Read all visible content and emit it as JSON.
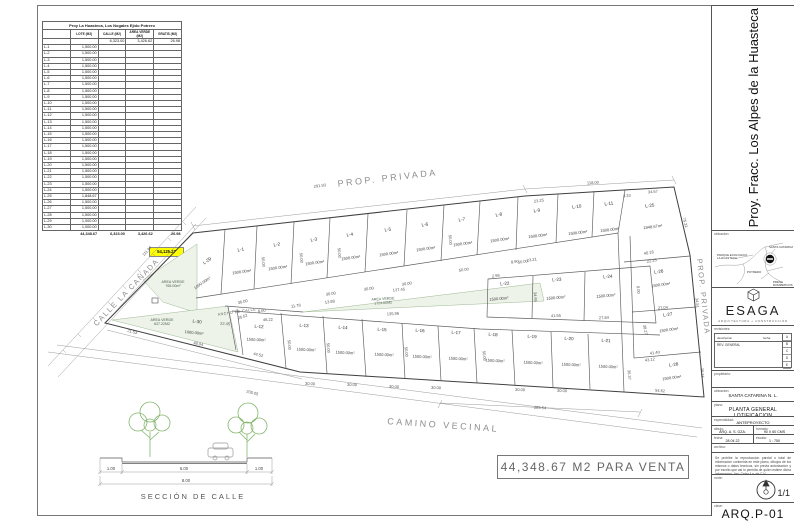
{
  "summary_table": {
    "title": "Proy La Huasteca, Los Nogales Ejido Potrero",
    "columns": [
      "",
      "LOTE (M2)",
      "CALLE (M2)",
      "AREA VERDE (M2)",
      "GRATIS (M2)"
    ],
    "subtotal_row": {
      "calle": "6,323.00",
      "area_verde": "3,426.62",
      "gratis": "26.98"
    },
    "rows": [
      {
        "id": "L-1",
        "lote": "1,500.00"
      },
      {
        "id": "L-2",
        "lote": "1,500.00"
      },
      {
        "id": "L-3",
        "lote": "1,500.00"
      },
      {
        "id": "L-4",
        "lote": "1,500.00"
      },
      {
        "id": "L-5",
        "lote": "1,500.00"
      },
      {
        "id": "L-6",
        "lote": "1,500.00"
      },
      {
        "id": "L-7",
        "lote": "1,500.00"
      },
      {
        "id": "L-8",
        "lote": "1,500.00"
      },
      {
        "id": "L-9",
        "lote": "1,500.00"
      },
      {
        "id": "L-10",
        "lote": "1,500.00"
      },
      {
        "id": "L-11",
        "lote": "1,500.00"
      },
      {
        "id": "L-12",
        "lote": "1,500.00"
      },
      {
        "id": "L-13",
        "lote": "1,500.00"
      },
      {
        "id": "L-14",
        "lote": "1,500.00"
      },
      {
        "id": "L-15",
        "lote": "1,500.00"
      },
      {
        "id": "L-16",
        "lote": "1,500.00"
      },
      {
        "id": "L-17",
        "lote": "1,500.00"
      },
      {
        "id": "L-18",
        "lote": "1,500.00"
      },
      {
        "id": "L-19",
        "lote": "1,500.00"
      },
      {
        "id": "L-20",
        "lote": "1,500.00"
      },
      {
        "id": "L-21",
        "lote": "1,500.00"
      },
      {
        "id": "L-22",
        "lote": "1,500.00"
      },
      {
        "id": "L-23",
        "lote": "1,500.00"
      },
      {
        "id": "L-24",
        "lote": "1,500.00"
      },
      {
        "id": "L-25",
        "lote": "1,848.67"
      },
      {
        "id": "L-26",
        "lote": "1,500.00"
      },
      {
        "id": "L-27",
        "lote": "1,500.00"
      },
      {
        "id": "L-28",
        "lote": "1,500.00"
      },
      {
        "id": "L-29",
        "lote": "1,000.00"
      },
      {
        "id": "L-30",
        "lote": "1,000.00"
      }
    ],
    "totals": {
      "lote": "44,348.67",
      "calle": "6,323.00",
      "area_verde": "3,426.62",
      "gratis": "26.98"
    },
    "grand_total": "54,125.27",
    "highlight_color": "#ffff00"
  },
  "plan": {
    "street_labels": {
      "prop_top": "PROP. PRIVADA",
      "prop_right": "PROP. PRIVADA",
      "camino": "CAMINO VECINAL",
      "calle": "CALLE LA CAÑADA",
      "ancho": "ANCHO DE CALLE"
    },
    "sale_note": "44,348.67 M2 PARA VENTA",
    "lots": [
      {
        "id": "L-29",
        "area": "1000.00m²",
        "x": 208,
        "y": 262,
        "r": -35,
        "ax": 203,
        "ay": 284
      },
      {
        "id": "L-1",
        "area": "1500.00m²",
        "x": 241,
        "y": 251,
        "r": -8,
        "ax": 242,
        "ay": 273
      },
      {
        "id": "L-2",
        "area": "1500.00m²",
        "x": 277,
        "y": 246,
        "r": -8,
        "ax": 278,
        "ay": 269
      },
      {
        "id": "L-3",
        "area": "1500.00m²",
        "x": 314,
        "y": 241,
        "r": -8,
        "ax": 315,
        "ay": 264
      },
      {
        "id": "L-4",
        "area": "1500.00m²",
        "x": 350,
        "y": 236,
        "r": -8,
        "ax": 351,
        "ay": 259
      },
      {
        "id": "L-5",
        "area": "1500.00m²",
        "x": 388,
        "y": 231,
        "r": -8,
        "ax": 389,
        "ay": 255
      },
      {
        "id": "L-6",
        "area": "1500.00m²",
        "x": 425,
        "y": 226,
        "r": -8,
        "ax": 426,
        "ay": 250
      },
      {
        "id": "L-7",
        "area": "1500.00m²",
        "x": 462,
        "y": 221,
        "r": -8,
        "ax": 463,
        "ay": 245
      },
      {
        "id": "L-8",
        "area": "1500.00m²",
        "x": 499,
        "y": 216,
        "r": -8,
        "ax": 500,
        "ay": 241
      },
      {
        "id": "L-9",
        "area": "1500.00m²",
        "x": 537,
        "y": 212,
        "r": -7,
        "ax": 538,
        "ay": 237
      },
      {
        "id": "L-10",
        "area": "1500.00m²",
        "x": 577,
        "y": 208,
        "r": -7,
        "ax": 578,
        "ay": 234
      },
      {
        "id": "L-11",
        "area": "1500.00m²",
        "x": 609,
        "y": 205,
        "r": -7,
        "ax": 610,
        "ay": 231
      },
      {
        "id": "L-25",
        "area": "1848.67m²",
        "x": 650,
        "y": 207,
        "r": -7,
        "ax": 653,
        "ay": 228
      },
      {
        "id": "L-26",
        "area": "1500.00m²",
        "x": 659,
        "y": 273,
        "r": -8,
        "ax": 661,
        "ay": 286
      },
      {
        "id": "L-27",
        "area": "1500.00m²",
        "x": 668,
        "y": 316,
        "r": -8,
        "ax": 669,
        "ay": 331
      },
      {
        "id": "L-28",
        "area": "1500.00m²",
        "x": 674,
        "y": 366,
        "r": -8,
        "ax": 672,
        "ay": 379
      },
      {
        "id": "L-22",
        "area": "1500.00m²",
        "x": 505,
        "y": 285,
        "r": -5,
        "ax": 499,
        "ay": 300
      },
      {
        "id": "L-23",
        "area": "1500.00m²",
        "x": 557,
        "y": 281,
        "r": -5,
        "ax": 556,
        "ay": 299
      },
      {
        "id": "L-24",
        "area": "1500.00m²",
        "x": 608,
        "y": 278,
        "r": -5,
        "ax": 606,
        "ay": 297
      },
      {
        "id": "L-30",
        "area": "1000.00m²",
        "x": 197,
        "y": 323,
        "r": 6,
        "ax": 194,
        "ay": 334
      },
      {
        "id": "L-12",
        "area": "1500.00m²",
        "x": 259,
        "y": 328,
        "r": 3,
        "ax": 256,
        "ay": 341
      },
      {
        "id": "L-13",
        "area": "1500.00m²",
        "x": 304,
        "y": 327,
        "r": 3,
        "ax": 306,
        "ay": 351
      },
      {
        "id": "L-14",
        "area": "1500.00m²",
        "x": 343,
        "y": 329,
        "r": 3,
        "ax": 345,
        "ay": 354
      },
      {
        "id": "L-15",
        "area": "1500.00m²",
        "x": 382,
        "y": 331,
        "r": 3,
        "ax": 384,
        "ay": 356
      },
      {
        "id": "L-16",
        "area": "1500.00m²",
        "x": 420,
        "y": 332,
        "r": 3,
        "ax": 422,
        "ay": 358
      },
      {
        "id": "L-17",
        "area": "1500.00m²",
        "x": 456,
        "y": 334,
        "r": 3,
        "ax": 458,
        "ay": 360
      },
      {
        "id": "L-18",
        "area": "1500.00m²",
        "x": 493,
        "y": 336,
        "r": 3,
        "ax": 495,
        "ay": 362
      },
      {
        "id": "L-19",
        "area": "1500.00m²",
        "x": 532,
        "y": 338,
        "r": 3,
        "ax": 533,
        "ay": 364
      },
      {
        "id": "L-20",
        "area": "1500.00m²",
        "x": 569,
        "y": 340,
        "r": 3,
        "ax": 571,
        "ay": 366
      },
      {
        "id": "L-21",
        "area": "1500.00m²",
        "x": 606,
        "y": 342,
        "r": 3,
        "ax": 608,
        "ay": 368
      }
    ],
    "green_areas": [
      {
        "label": "AREA VERDE",
        "area": "765.00m²",
        "x": 173,
        "y": 283,
        "r": 0
      },
      {
        "label": "AREA VERDE",
        "area": "637.22M2",
        "x": 162,
        "y": 321,
        "r": 0
      },
      {
        "label": "AREA VERDE",
        "area": "1724.00M2",
        "x": 383,
        "y": 300,
        "r": -3
      }
    ],
    "dims": [
      [
        "291.93",
        320,
        187,
        -7
      ],
      [
        "118.00",
        593,
        184,
        -4
      ],
      [
        "111.97",
        148,
        252,
        -46
      ],
      [
        "205.05",
        252,
        394,
        14
      ],
      [
        "285.54",
        540,
        409,
        3
      ],
      [
        "75.31",
        684,
        223,
        75
      ],
      [
        "34.51",
        696,
        303,
        83
      ],
      [
        "29.15",
        701,
        373,
        85
      ],
      [
        "54.62",
        660,
        392,
        5
      ],
      [
        "23.25",
        539,
        202,
        -7
      ],
      [
        "3.33",
        627,
        197,
        -5
      ],
      [
        "34.57",
        653,
        193,
        -5
      ],
      [
        "40.18",
        649,
        254,
        -10
      ],
      [
        "22.25",
        652,
        262,
        -10
      ],
      [
        "27.04",
        663,
        309,
        -5
      ],
      [
        "38.27",
        644,
        330,
        80
      ],
      [
        "41.40",
        655,
        354,
        -7
      ],
      [
        "43.12",
        650,
        361,
        -7
      ],
      [
        "27.84",
        604,
        319,
        -3
      ],
      [
        "41.55",
        556,
        317,
        -3
      ],
      [
        "34.95",
        534,
        297,
        85
      ],
      [
        "23.21",
        532,
        261,
        -8
      ],
      [
        "8.90",
        515,
        263,
        -8
      ],
      [
        "2.98",
        496,
        277,
        -8
      ],
      [
        "137.45",
        399,
        291,
        -6
      ],
      [
        "135.96",
        393,
        315,
        -3
      ],
      [
        "22.45",
        225,
        325,
        5
      ],
      [
        "25.52",
        243,
        318,
        -18
      ],
      [
        "21.53",
        132,
        333,
        14
      ],
      [
        "48.04",
        198,
        345,
        13
      ],
      [
        "44.52",
        258,
        356,
        13
      ],
      [
        "46.22",
        268,
        321,
        -3
      ],
      [
        "36.00",
        243,
        303,
        -12
      ],
      [
        "11.78",
        296,
        307,
        -8
      ],
      [
        "13.88",
        330,
        303,
        -8
      ],
      [
        "8.00",
        262,
        312,
        -8
      ],
      [
        "50.00",
        464,
        271,
        -8
      ],
      [
        "30.00",
        331,
        295,
        -9
      ],
      [
        "30.00",
        369,
        290,
        -9
      ],
      [
        "30.00",
        407,
        285,
        -9
      ],
      [
        "50.00",
        523,
        263,
        -8
      ],
      [
        "30.00",
        310,
        385,
        3
      ],
      [
        "30.00",
        352,
        386,
        3
      ],
      [
        "30.00",
        394,
        388,
        3
      ],
      [
        "30.00",
        436,
        389,
        3
      ],
      [
        "30.00",
        520,
        391,
        3
      ],
      [
        "30.00",
        562,
        392,
        3
      ],
      [
        "50.00",
        262,
        262,
        85
      ],
      [
        "50.00",
        300,
        258,
        85
      ],
      [
        "50.00",
        338,
        253,
        85
      ],
      [
        "50.00",
        449,
        240,
        85
      ],
      [
        "50.00",
        288,
        345,
        85
      ],
      [
        "50.00",
        327,
        348,
        85
      ],
      [
        "50.00",
        405,
        352,
        85
      ],
      [
        "50.00",
        483,
        356,
        85
      ],
      [
        "36.37",
        628,
        375,
        85
      ],
      [
        "8.00",
        637,
        290,
        85
      ]
    ]
  },
  "street_section": {
    "label": "SECCIÓN DE CALLE",
    "dim_left": "1.00",
    "dim_center": "6.00",
    "dim_right": "1.00",
    "dim_total": "8.00"
  },
  "title_block": {
    "project_title": "Proy. Fracc. Los Alpes de la Huasteca",
    "ubicacion_map_label": "ubicacion:",
    "map_labels": [
      {
        "text": "SANTA CATARINA",
        "x": 56,
        "y": 11
      },
      {
        "text": "PARQUE ECOLOGICO\nLA HUASTECA",
        "x": 4,
        "y": 19
      },
      {
        "text": "POTRERO",
        "x": 34,
        "y": 36
      },
      {
        "text": "PRESA\nROMPEPICOS",
        "x": 60,
        "y": 46
      }
    ],
    "logo": {
      "name": "ESAGA",
      "tagline": "ARQUITECTURA  +  CONSTRUCCION"
    },
    "revisiones": {
      "label": "revisiones:",
      "col_descripcion": "descripcion",
      "col_fecha": "fecha",
      "row1": "REV. GENERAL",
      "letters": [
        "A",
        "B",
        "C",
        "D",
        "E"
      ]
    },
    "fields": {
      "propietario_label": "propietario:",
      "ubicacion_label": "ubicacion:",
      "ubicacion_value": "SANTA CATARINA N. L.",
      "plano_label": "plano:",
      "plano_value": "PLANTA GENERAL LOTIFICACION",
      "especialidad_label": "especialidad:",
      "especialidad_value": "ANTEPROYECTO",
      "dibujo_label": "dibujo:",
      "dibujo_value": "ARQ. A. S. GZA.",
      "formato_label": "formato:",
      "formato_value": "90 X 60 CMS",
      "fecha_label": "fecha:",
      "fecha_value": "28 04 22",
      "escala_label": "escala:",
      "escala_value": "1 : 750",
      "archivo_label": "archivo:"
    },
    "disclaimer": "Se prohibe la reproduccion parcial o total de informacion contenida en este plano, dibujos de los mismos o datos tecnicos, sin previa autorizacion y por escrito que asi lo permita de quien estime dicha informacion. Arq. Celso f.a. de C.V.",
    "norte_label": "norte:",
    "sheet_number": "1/1",
    "clave_label": "clave:",
    "clave_value": "ARQ.P-01"
  }
}
